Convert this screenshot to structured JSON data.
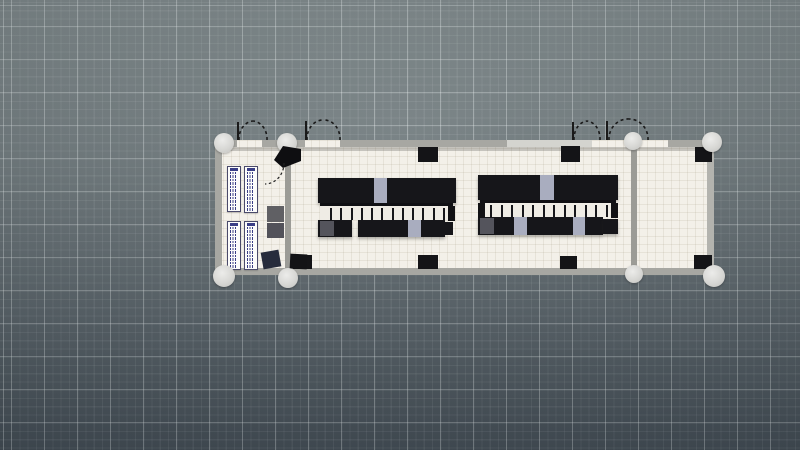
{
  "app": {
    "view_label": "floor-plan-3d-viewport",
    "visible_text": "none — drawing contains only sub-legible micro-text in legend tables"
  },
  "colors": {
    "background_top": "#7d8789",
    "background_bottom": "#48525a",
    "grid_major": "rgba(238,244,244,0.30)",
    "grid_minor": "rgba(238,244,244,0.08)",
    "floor": "#f3f0e9",
    "wall": "#a7a7a2",
    "wall_light": "#d4d4cf",
    "inner_wall": "#9c9c97",
    "pillar": "#141417",
    "rack_black": "#16161a",
    "rack_light_slot": "#a9adbf",
    "rack_dark_slot": "#54545c",
    "column_dome": "#d7d7d4",
    "legend_ink": "#3a3e86",
    "aisle_floor": "#efece5"
  },
  "grid": {
    "major_step_px": 33,
    "minor_step_px": 8.25
  },
  "scene": {
    "floor": {
      "name": "building-floor",
      "x": 215,
      "y": 140,
      "w": 499,
      "h": 135
    },
    "rects": [
      {
        "name": "wall-shadow-top",
        "x": 221,
        "y": 147,
        "w": 486,
        "h": 4,
        "fill": "rgba(80,80,75,0.28)"
      },
      {
        "name": "wall-top-1",
        "x": 215,
        "y": 140,
        "w": 22,
        "h": 7,
        "fill": "#a7a7a2"
      },
      {
        "name": "wall-top-2",
        "x": 262,
        "y": 140,
        "w": 43,
        "h": 7,
        "fill": "#a7a7a2"
      },
      {
        "name": "wall-top-3",
        "x": 340,
        "y": 140,
        "w": 167,
        "h": 7,
        "fill": "#a7a7a2"
      },
      {
        "name": "wall-top-4-light",
        "x": 507,
        "y": 140,
        "w": 85,
        "h": 7,
        "fill": "#d4d4cf"
      },
      {
        "name": "wall-top-5",
        "x": 630,
        "y": 140,
        "w": 8,
        "h": 7,
        "fill": "#a7a7a2"
      },
      {
        "name": "wall-top-6",
        "x": 668,
        "y": 140,
        "w": 46,
        "h": 7,
        "fill": "#a7a7a2"
      },
      {
        "name": "wall-bottom",
        "x": 215,
        "y": 268,
        "w": 499,
        "h": 7,
        "fill": "#a7a7a2"
      },
      {
        "name": "wall-left",
        "x": 215,
        "y": 140,
        "w": 7,
        "h": 135,
        "fill": "#a7a7a2"
      },
      {
        "name": "wall-right",
        "x": 707,
        "y": 140,
        "w": 7,
        "h": 135,
        "fill": "#b3b3ae"
      },
      {
        "name": "wall-inner-left",
        "x": 285,
        "y": 150,
        "w": 6,
        "h": 118,
        "fill": "#9c9c97"
      },
      {
        "name": "wall-inner-right",
        "x": 631,
        "y": 147,
        "w": 6,
        "h": 121,
        "fill": "#9c9c97"
      },
      {
        "name": "pillar-top-1",
        "x": 418,
        "y": 147,
        "w": 20,
        "h": 15,
        "fill": "#141417"
      },
      {
        "name": "pillar-top-2",
        "x": 561,
        "y": 146,
        "w": 19,
        "h": 16,
        "fill": "#141417"
      },
      {
        "name": "pillar-right-room-top",
        "x": 695,
        "y": 147,
        "w": 17,
        "h": 15,
        "fill": "#141417"
      },
      {
        "name": "pillar-bottom-1",
        "x": 293,
        "y": 255,
        "w": 19,
        "h": 14,
        "fill": "#141417"
      },
      {
        "name": "pillar-bottom-2",
        "x": 418,
        "y": 255,
        "w": 20,
        "h": 14,
        "fill": "#141417"
      },
      {
        "name": "pillar-bottom-3",
        "x": 560,
        "y": 256,
        "w": 17,
        "h": 13,
        "fill": "#141417"
      },
      {
        "name": "pillar-right-room-bottom",
        "x": 694,
        "y": 255,
        "w": 18,
        "h": 14,
        "fill": "#141417"
      },
      {
        "name": "rack-row-left-top",
        "x": 318,
        "y": 178,
        "w": 138,
        "h": 25,
        "fill": "#16161a",
        "cls": "rack"
      },
      {
        "name": "rack-slot-light",
        "x": 374,
        "y": 178,
        "w": 13,
        "h": 25,
        "fill": "#a9adbf"
      },
      {
        "name": "rack-row-left-bottom-a",
        "x": 318,
        "y": 220,
        "w": 34,
        "h": 17,
        "fill": "#16161a",
        "cls": "rack"
      },
      {
        "name": "rack-row-left-bottom-b",
        "x": 358,
        "y": 220,
        "w": 87,
        "h": 17,
        "fill": "#16161a",
        "cls": "rack"
      },
      {
        "name": "rack-slot-dark",
        "x": 320,
        "y": 221,
        "w": 14,
        "h": 15,
        "fill": "#54545c"
      },
      {
        "name": "rack-slot-light",
        "x": 408,
        "y": 220,
        "w": 13,
        "h": 17,
        "fill": "#a9adbf"
      },
      {
        "name": "rack-stub",
        "x": 445,
        "y": 222,
        "w": 8,
        "h": 13,
        "fill": "#16161a"
      },
      {
        "name": "rack-row-right-top",
        "x": 478,
        "y": 175,
        "w": 140,
        "h": 25,
        "fill": "#16161a",
        "cls": "rack"
      },
      {
        "name": "rack-slot-light",
        "x": 540,
        "y": 175,
        "w": 14,
        "h": 25,
        "fill": "#a9adbf"
      },
      {
        "name": "rack-row-right-bottom-a",
        "x": 478,
        "y": 217,
        "w": 125,
        "h": 18,
        "fill": "#16161a",
        "cls": "rack"
      },
      {
        "name": "rack-row-right-bottom-b",
        "x": 603,
        "y": 219,
        "w": 15,
        "h": 15,
        "fill": "#16161a",
        "cls": "rack"
      },
      {
        "name": "rack-slot-dark",
        "x": 480,
        "y": 218,
        "w": 14,
        "h": 16,
        "fill": "#54545c"
      },
      {
        "name": "rack-slot-light",
        "x": 514,
        "y": 217,
        "w": 13,
        "h": 18,
        "fill": "#a9adbf"
      },
      {
        "name": "rack-slot-light",
        "x": 573,
        "y": 217,
        "w": 12,
        "h": 18,
        "fill": "#a9adbf"
      },
      {
        "name": "equipment-box-gray-1",
        "x": 267,
        "y": 206,
        "w": 17,
        "h": 16,
        "fill": "#606064"
      },
      {
        "name": "equipment-box-gray-2",
        "x": 267,
        "y": 223,
        "w": 17,
        "h": 15,
        "fill": "#52525a"
      },
      {
        "name": "equipment-box-navy",
        "x": 262,
        "y": 251,
        "w": 18,
        "h": 17,
        "fill": "#272c3c",
        "rot": -10
      },
      {
        "name": "equipment-box-black",
        "x": 290,
        "y": 254,
        "w": 17,
        "h": 15,
        "fill": "#131316",
        "rot": 3
      }
    ],
    "aisles": [
      {
        "name": "containment-aisle-left",
        "x": 320,
        "y": 203,
        "w": 133,
        "h": 17,
        "fill": "#efece5",
        "dividers": 12,
        "caps": [
          "right"
        ]
      },
      {
        "name": "containment-aisle-right",
        "x": 480,
        "y": 200,
        "w": 136,
        "h": 17,
        "fill": "#efece5",
        "dividers": 12,
        "caps": [
          "left",
          "right"
        ]
      }
    ],
    "legend_tables": [
      {
        "name": "legend-table-1",
        "x": 227,
        "y": 166,
        "w": 14,
        "h": 46,
        "rows": 12
      },
      {
        "name": "legend-table-2",
        "x": 244,
        "y": 166,
        "w": 14,
        "h": 47,
        "rows": 12
      },
      {
        "name": "legend-table-3",
        "x": 227,
        "y": 221,
        "w": 14,
        "h": 49,
        "rows": 13
      },
      {
        "name": "legend-table-4",
        "x": 244,
        "y": 221,
        "w": 14,
        "h": 49,
        "rows": 13
      }
    ],
    "round_columns": [
      {
        "name": "round-column-top-left-1",
        "cx": 224,
        "cy": 143,
        "r": 10
      },
      {
        "name": "round-column-top-left-2",
        "cx": 287,
        "cy": 143,
        "r": 10
      },
      {
        "name": "round-column-top-right-1",
        "cx": 633,
        "cy": 141,
        "r": 9
      },
      {
        "name": "round-column-top-right-2",
        "cx": 712,
        "cy": 142,
        "r": 10
      },
      {
        "name": "round-column-bottom-left-1",
        "cx": 224,
        "cy": 276,
        "r": 11
      },
      {
        "name": "round-column-bottom-left-2",
        "cx": 288,
        "cy": 278,
        "r": 10
      },
      {
        "name": "round-column-bottom-right-1",
        "cx": 634,
        "cy": 274,
        "r": 9
      },
      {
        "name": "round-column-bottom-right-2",
        "cx": 714,
        "cy": 276,
        "r": 11
      }
    ],
    "svg_paths": [
      {
        "name": "door-jamb-tick",
        "d": "M238,122 L238,140",
        "stroke": "#1a1a1a",
        "width": 2
      },
      {
        "name": "door-swing-arc",
        "d": "M239,140 A15,18 0 0 1 253,121",
        "stroke": "#1a1a1a",
        "width": 1.6,
        "dash": "3 3"
      },
      {
        "name": "door-swing-arc",
        "d": "M267,140 A15,18 0 0 0 253,121",
        "stroke": "#1a1a1a",
        "width": 1.6,
        "dash": "3 3"
      },
      {
        "name": "door-jamb-tick",
        "d": "M306,121 L306,140",
        "stroke": "#1a1a1a",
        "width": 2
      },
      {
        "name": "door-swing-arc",
        "d": "M307,140 A16,19 0 0 1 323,120",
        "stroke": "#1a1a1a",
        "width": 1.6,
        "dash": "3 3"
      },
      {
        "name": "door-swing-arc",
        "d": "M340,140 A16,19 0 0 0 323,120",
        "stroke": "#1a1a1a",
        "width": 1.6,
        "dash": "3 3"
      },
      {
        "name": "door-jamb-tick",
        "d": "M573,122 L573,140",
        "stroke": "#1a1a1a",
        "width": 2
      },
      {
        "name": "door-swing-arc",
        "d": "M574,140 A14,18 0 0 1 587,121",
        "stroke": "#1a1a1a",
        "width": 1.6,
        "dash": "3 3"
      },
      {
        "name": "door-swing-arc",
        "d": "M600,140 A14,18 0 0 0 587,121",
        "stroke": "#1a1a1a",
        "width": 1.6,
        "dash": "3 3"
      },
      {
        "name": "door-jamb-tick",
        "d": "M607,121 L607,140",
        "stroke": "#1a1a1a",
        "width": 2
      },
      {
        "name": "door-swing-arc",
        "d": "M609,140 A19,20 0 0 1 629,119",
        "stroke": "#1a1a1a",
        "width": 1.6,
        "dash": "3 3"
      },
      {
        "name": "door-swing-arc",
        "d": "M648,140 A19,20 0 0 0 629,119",
        "stroke": "#1a1a1a",
        "width": 1.6,
        "dash": "3 3"
      },
      {
        "name": "open-door-leaf",
        "d": "M301,149 L283,146 L274,160 L283,168 L301,161 Z",
        "fill": "#0e0e11"
      },
      {
        "name": "door-swing-arc-inner",
        "d": "M284,163 A19,21 0 0 1 265,184",
        "stroke": "#222222",
        "width": 1.2,
        "dash": "2.5 2.5"
      }
    ]
  }
}
